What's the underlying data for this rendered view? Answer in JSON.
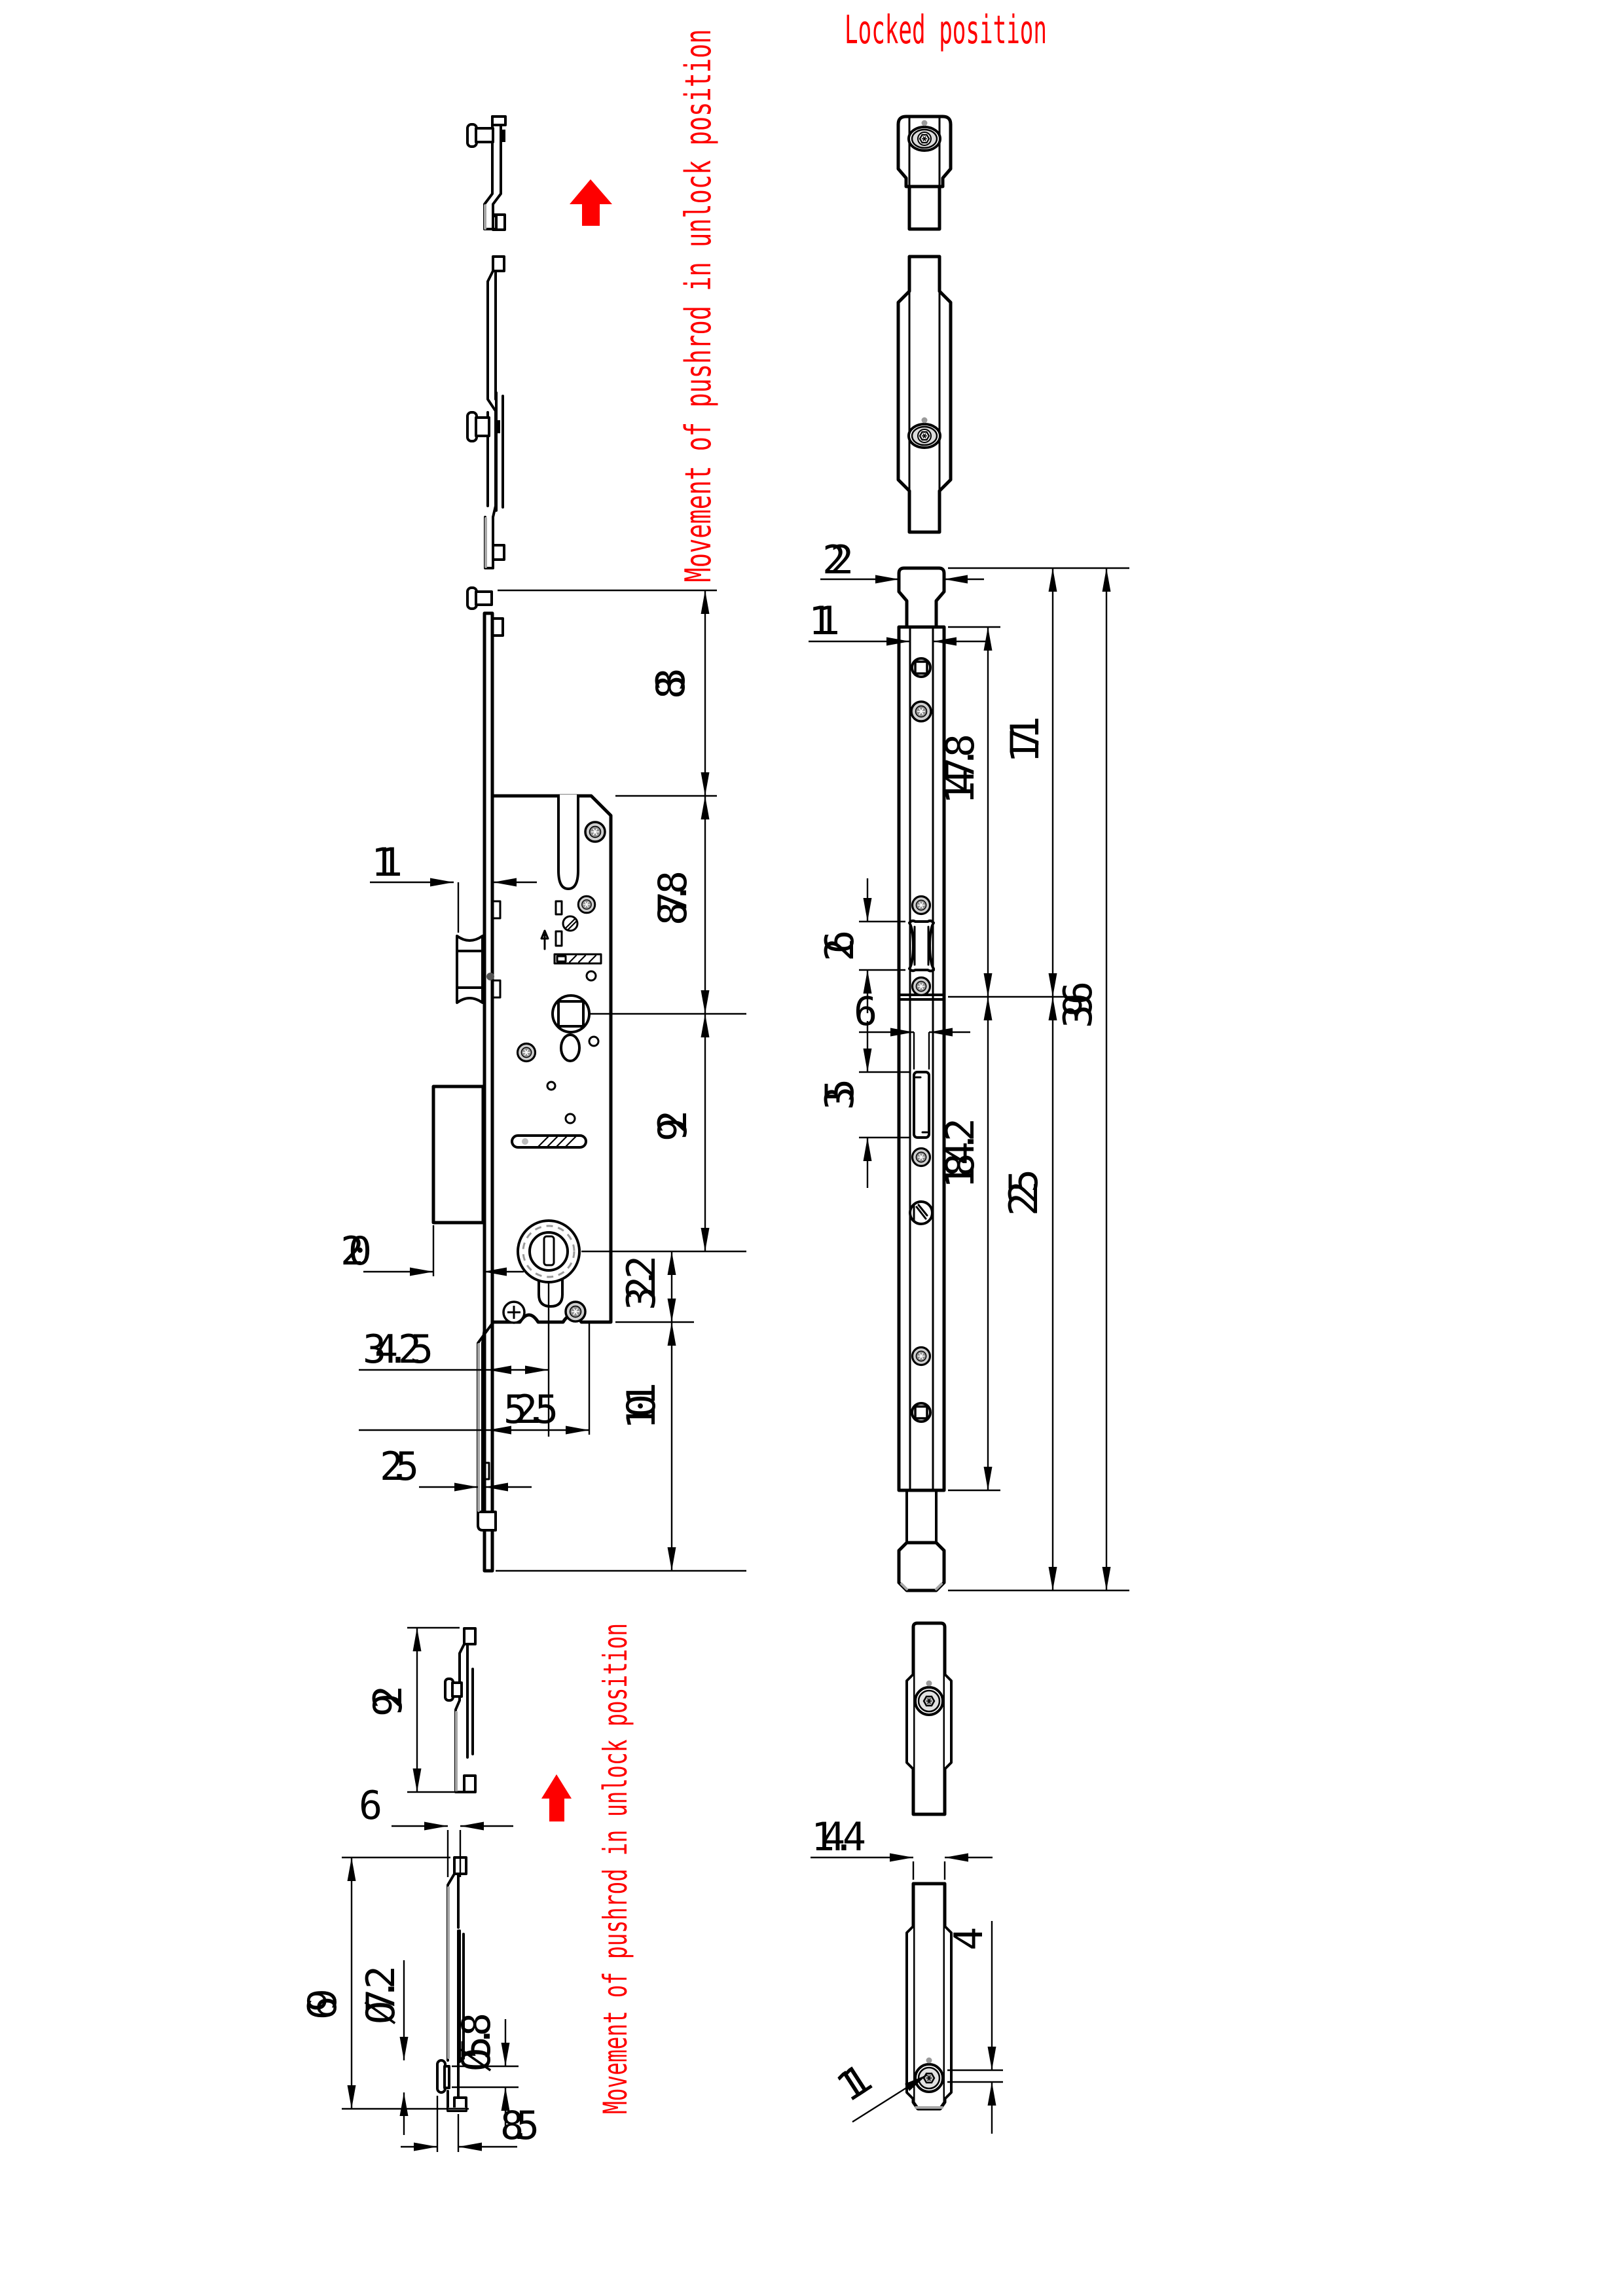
{
  "labels": {
    "locked_position": "Locked position",
    "movement_unlock_top": "Movement of pushrod in unlock position",
    "movement_unlock_bottom": "Movement of pushrod in unlock position"
  },
  "colors": {
    "line": "#000000",
    "annotation": "#fe0000",
    "screw_fill": "#cfcfcf",
    "screw_core": "#8f8f8f",
    "shade": "#a6a6a6",
    "background": "#ffffff"
  },
  "views": {
    "lock_side": {
      "dims": {
        "d83": "83",
        "d87_8": "87.8",
        "d92": "92",
        "d32_2": "32.2",
        "d101": "101",
        "d11": "11",
        "d20": "20",
        "d34_25": "34.25",
        "d52_5": "52.5",
        "d2_5": "2.5"
      }
    },
    "pushrod_front": {
      "dims": {
        "d22": "22",
        "d11": "11",
        "d147_8": "147.8",
        "d171": "171",
        "d396": "396",
        "d26": "26",
        "d6": "6",
        "d35": "35",
        "d184_2": "184.2",
        "d225": "225"
      }
    },
    "pushrod_detail_side": {
      "dims": {
        "d92": "92",
        "d6": "6",
        "d69": "69",
        "dia7_2": "Ø7.2",
        "dia5_8": "Ø5.8",
        "d8_5": "8.5"
      }
    },
    "pushrod_detail_front": {
      "dims": {
        "d14_4": "14.4",
        "d4": "4",
        "d11": "11"
      }
    }
  }
}
